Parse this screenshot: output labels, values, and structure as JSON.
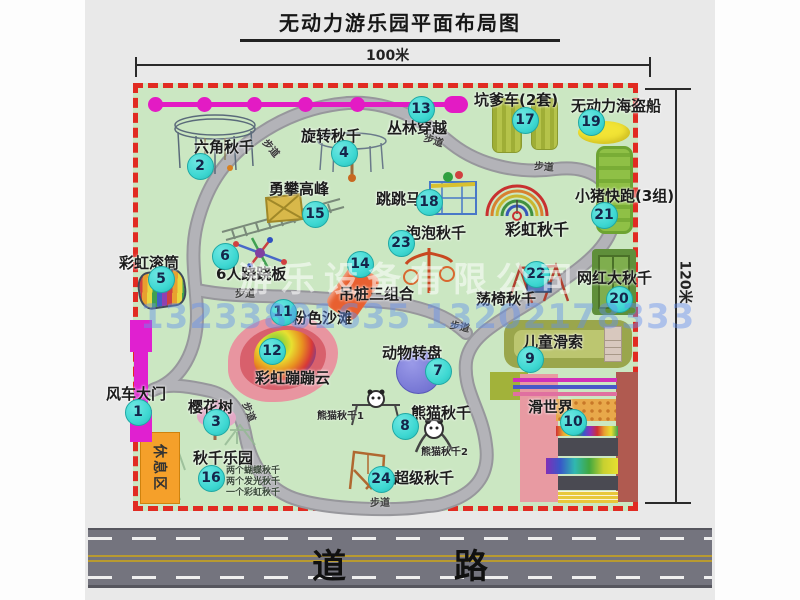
{
  "title": "无动力游乐园平面布局图",
  "dimensions": {
    "top": "100米",
    "right": "120米"
  },
  "road_label": "道 路",
  "walkway_label": "步道",
  "rest_area_label": "休息区",
  "watermark": {
    "company": "游乐设备有限公司",
    "phone": "13233801635 13202178333"
  },
  "extra_labels": {
    "rainbow_swing": "彩虹秋千",
    "panda_swing_1": "熊猫秋千1",
    "panda_swing_2": "熊猫秋千2"
  },
  "swing_park_details": "两个蝴蝶秋千\n两个发光秋千\n一个彩虹秋千",
  "attractions": [
    {
      "num": "1",
      "name": "风车大门"
    },
    {
      "num": "2",
      "name": "六角秋千"
    },
    {
      "num": "3",
      "name": "樱花树"
    },
    {
      "num": "4",
      "name": "旋转秋千"
    },
    {
      "num": "5",
      "name": "彩虹滚筒"
    },
    {
      "num": "6",
      "name": "6人跷跷板"
    },
    {
      "num": "7",
      "name": "动物转盘"
    },
    {
      "num": "8",
      "name": "熊猫秋千"
    },
    {
      "num": "9",
      "name": "儿童滑索"
    },
    {
      "num": "10",
      "name": "滑世界"
    },
    {
      "num": "11",
      "name": "粉色沙滩"
    },
    {
      "num": "12",
      "name": "彩虹蹦蹦云"
    },
    {
      "num": "13",
      "name": "丛林穿越"
    },
    {
      "num": "14",
      "name": "吊桩三组合"
    },
    {
      "num": "15",
      "name": "勇攀高峰"
    },
    {
      "num": "16",
      "name": "秋千乐园"
    },
    {
      "num": "17",
      "name": "坑爹车(2套)"
    },
    {
      "num": "18",
      "name": "跳跳马"
    },
    {
      "num": "19",
      "name": "无动力海盗船"
    },
    {
      "num": "20",
      "name": "网红大秋千"
    },
    {
      "num": "21",
      "name": "小猪快跑(3组)"
    },
    {
      "num": "22",
      "name": "荡椅秋千"
    },
    {
      "num": "23",
      "name": "泡泡秋千"
    },
    {
      "num": "24",
      "name": "超级秋千"
    }
  ],
  "colors": {
    "park_green": "#cbe7c2",
    "border_red": "#e12b22",
    "marker_teal": "#3ed8d2",
    "zipline_magenta": "#e31bc4",
    "gate_magenta": "#e020d0",
    "rest_orange": "#f5a02a",
    "road_gray": "#74747e"
  }
}
